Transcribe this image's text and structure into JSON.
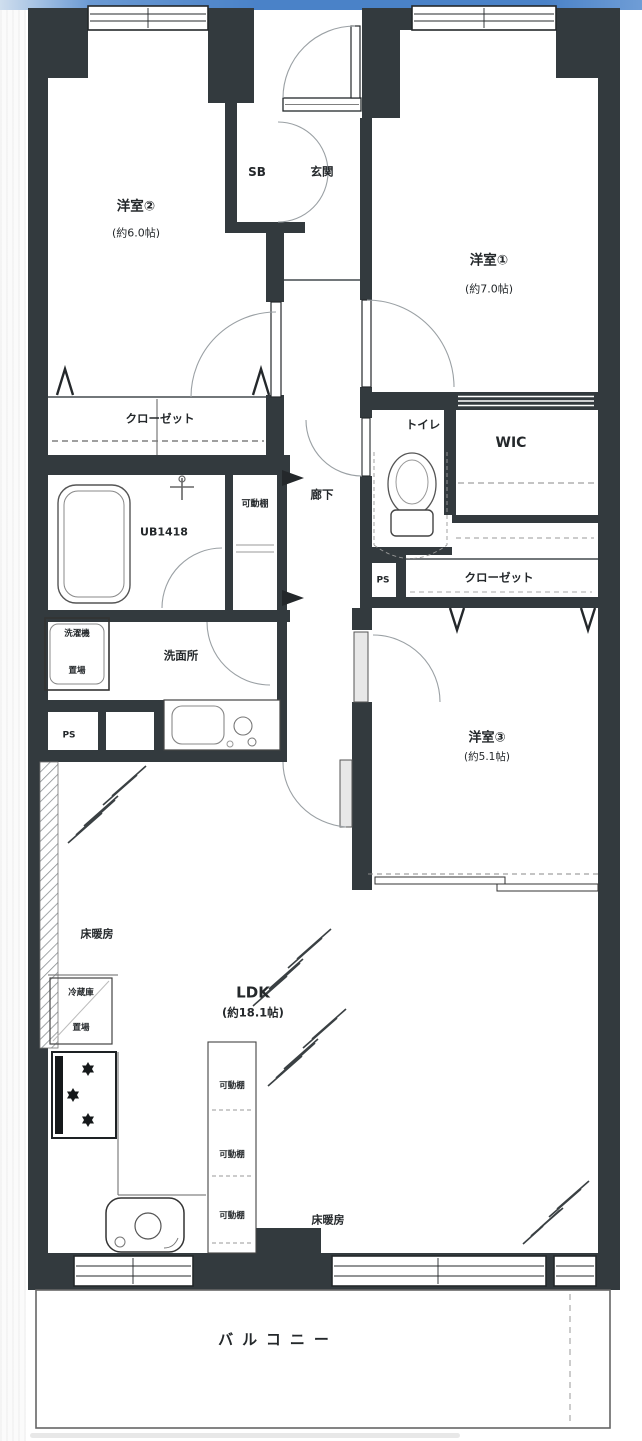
{
  "colors": {
    "wall": "#333a3e",
    "accent_bar_blue": "#4a82c8"
  },
  "labels": {
    "room2_name": "洋室②",
    "room2_size": "(約6.0帖)",
    "room1_name": "洋室①",
    "room1_size": "(約7.0帖)",
    "room3_name": "洋室③",
    "room3_size": "(約5.1帖)",
    "ldk_name": "LDK",
    "ldk_size": "(約18.1帖)",
    "shoe_box": "SB",
    "entrance": "玄関",
    "hallway": "廊下",
    "closet_west": "クローゼット",
    "closet_east": "クローゼット",
    "toilet": "トイレ",
    "wic": "WIC",
    "unit_bath": "UB1418",
    "movable_shelf_bath": "可動棚",
    "movable_shelf_k1": "可動棚",
    "movable_shelf_k2": "可動棚",
    "movable_shelf_k3": "可動棚",
    "washroom": "洗面所",
    "washer_line1": "洗濯機",
    "washer_line2": "置場",
    "fridge_line1": "冷蔵庫",
    "fridge_line2": "置場",
    "ps_left": "PS",
    "ps_right": "PS",
    "floor_heating_1": "床暖房",
    "floor_heating_2": "床暖房",
    "balcony": "バルコニー"
  }
}
